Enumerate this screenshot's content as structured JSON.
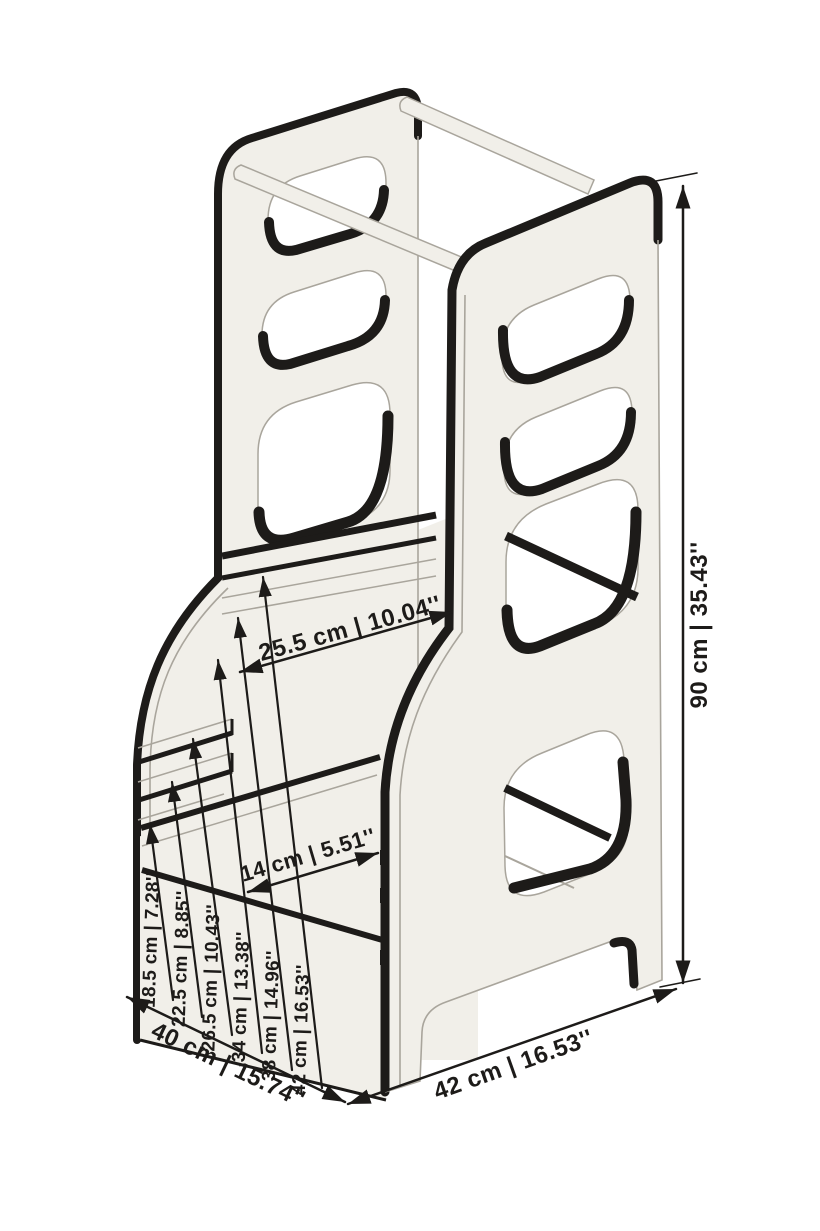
{
  "figure": {
    "type": "product-dimension-diagram",
    "subject": "learning-tower-step-stool",
    "colors": {
      "background": "#ffffff",
      "panel": "#f1efe9",
      "outline": "#1d1b19",
      "soft_line": "#a9a59c",
      "text": "#1d1b19"
    },
    "dimensions": {
      "height": "90 cm | 35.43''",
      "platform_depth": "25.5 cm | 10.04''",
      "step_depth": "14 cm | 5.51''",
      "base_depth": "40 cm | 15.74''",
      "base_width": "42 cm | 16.53''",
      "platform_heights": [
        "18.5 cm | 7.28''",
        "22.5 cm | 8.85''",
        "26.5 cm | 10.43''",
        "34 cm | 13.38''",
        "38 cm | 14.96''",
        "42 cm | 16.53''"
      ]
    }
  }
}
